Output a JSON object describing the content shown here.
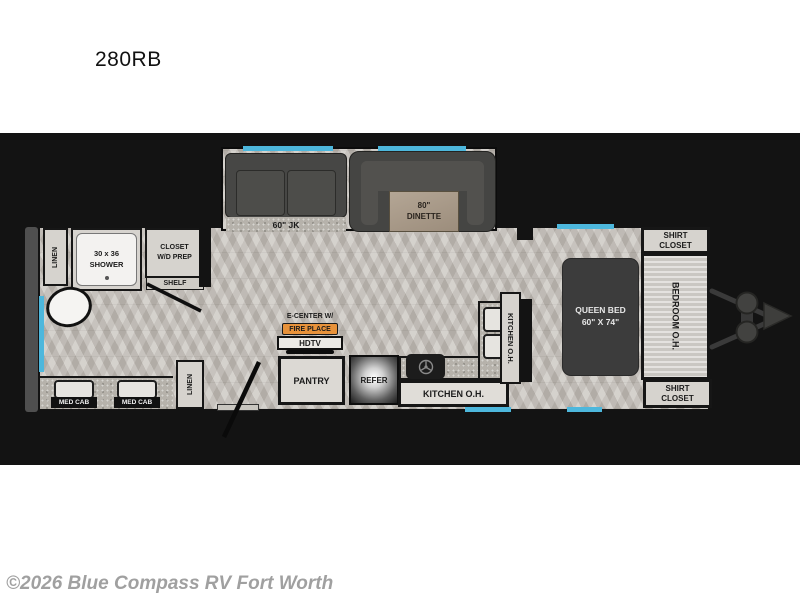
{
  "page": {
    "model": "280RB",
    "copyright": "©2026 Blue Compass RV Fort Worth"
  },
  "colors": {
    "window_blue": "#4db7dc",
    "fireplace_orange": "#e8923a",
    "band_black": "#131313"
  },
  "floorplan": {
    "rear_bath": {
      "linen_rear": "LINEN",
      "shower_size": "30 x 36",
      "shower": "SHOWER",
      "closet_line1": "CLOSET",
      "closet_line2": "W/D PREP",
      "shelf": "SHELF",
      "med_cab_left": "MED CAB",
      "med_cab_right": "MED CAB",
      "linen_front": "LINEN"
    },
    "living": {
      "sofa": "60\" JK",
      "dinette_size": "80\"",
      "dinette": "DINETTE",
      "ecenter": "E-CENTER W/",
      "fireplace": "FIRE PLACE",
      "hdtv": "HDTV",
      "pantry": "PANTRY",
      "refer": "REFER"
    },
    "kitchen": {
      "overhead_side": "KITCHEN O.H.",
      "overhead_bottom": "KITCHEN O.H."
    },
    "bedroom": {
      "bed_line1": "QUEEN BED",
      "bed_line2": "60\" X 74\"",
      "overhead": "BEDROOM O.H.",
      "shirt_closet_top_line1": "SHIRT",
      "shirt_closet_top_line2": "CLOSET",
      "shirt_closet_bottom_line1": "SHIRT",
      "shirt_closet_bottom_line2": "CLOSET"
    }
  }
}
